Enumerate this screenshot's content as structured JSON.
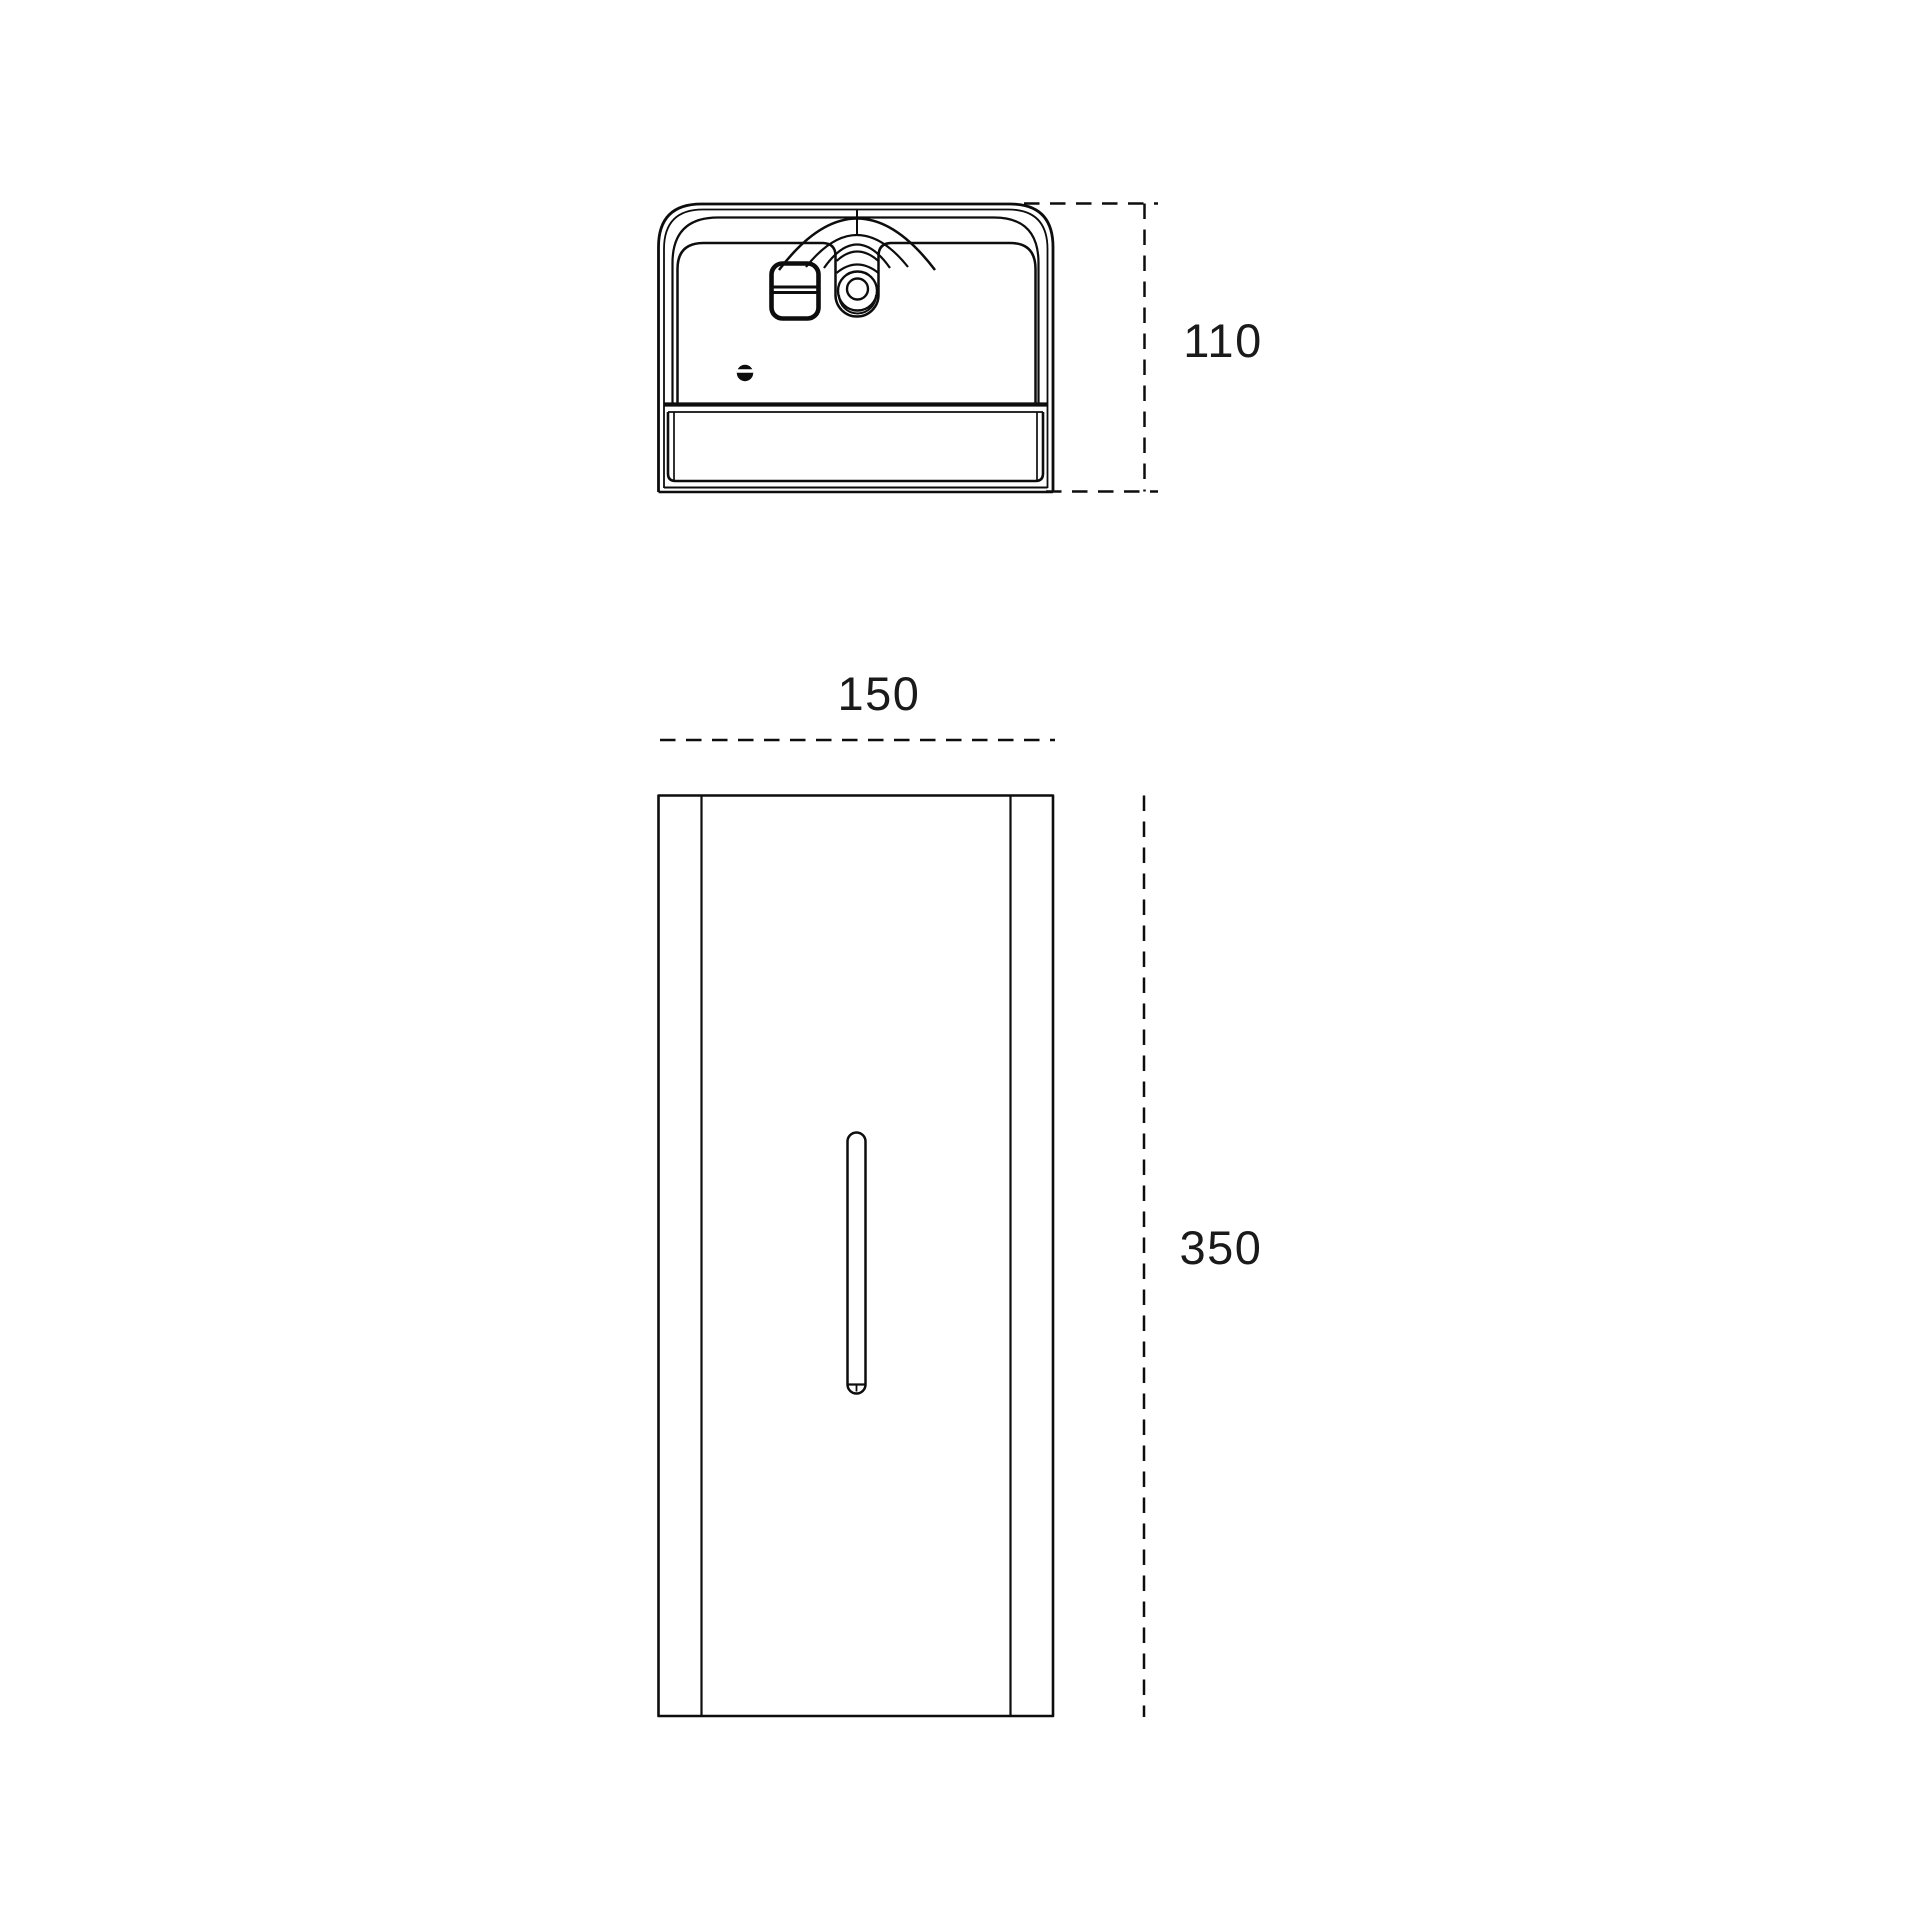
{
  "style": {
    "background": "#ffffff",
    "line_color": "#0d0d0d",
    "text_color": "#1a1a1a"
  },
  "drawing": {
    "top_view": {
      "depth_dimension": "110"
    },
    "front_view": {
      "width_dimension": "150",
      "height_dimension": "350"
    }
  }
}
